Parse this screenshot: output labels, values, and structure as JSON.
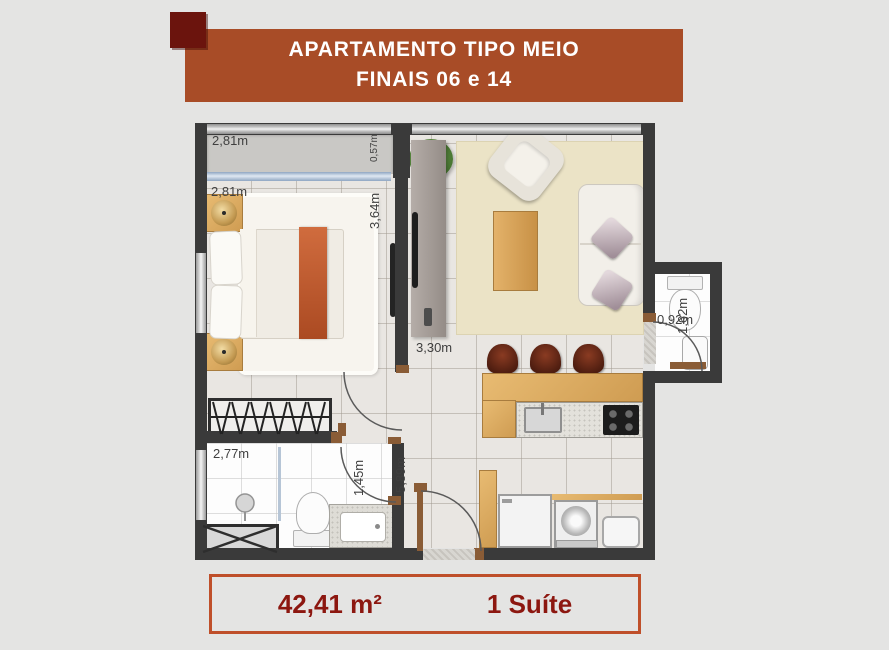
{
  "banner": {
    "line1": "APARTAMENTO TIPO MEIO",
    "line2": "FINAIS 06 e 14"
  },
  "footer": {
    "area": "42,41 m²",
    "suites": "1 Suíte"
  },
  "dimensions": {
    "balcony_width": "2,81m",
    "balcony_depth": "0,57m",
    "bedroom_width": "2,81m",
    "bedroom_length": "3,64m",
    "living_width": "3,30m",
    "living_length": "5,89m",
    "bathroom_width": "2,77m",
    "bathroom_door": "1,45m",
    "lavabo_length": "1,62m",
    "lavabo_width": "0,92m"
  },
  "colors": {
    "banner": "#a84c27",
    "square": "#6b140d",
    "wall": "#3a3a3a",
    "accent": "#8c1710",
    "wood": "#dfae65",
    "runner": "#c4602f",
    "stool": "#5e2517"
  }
}
